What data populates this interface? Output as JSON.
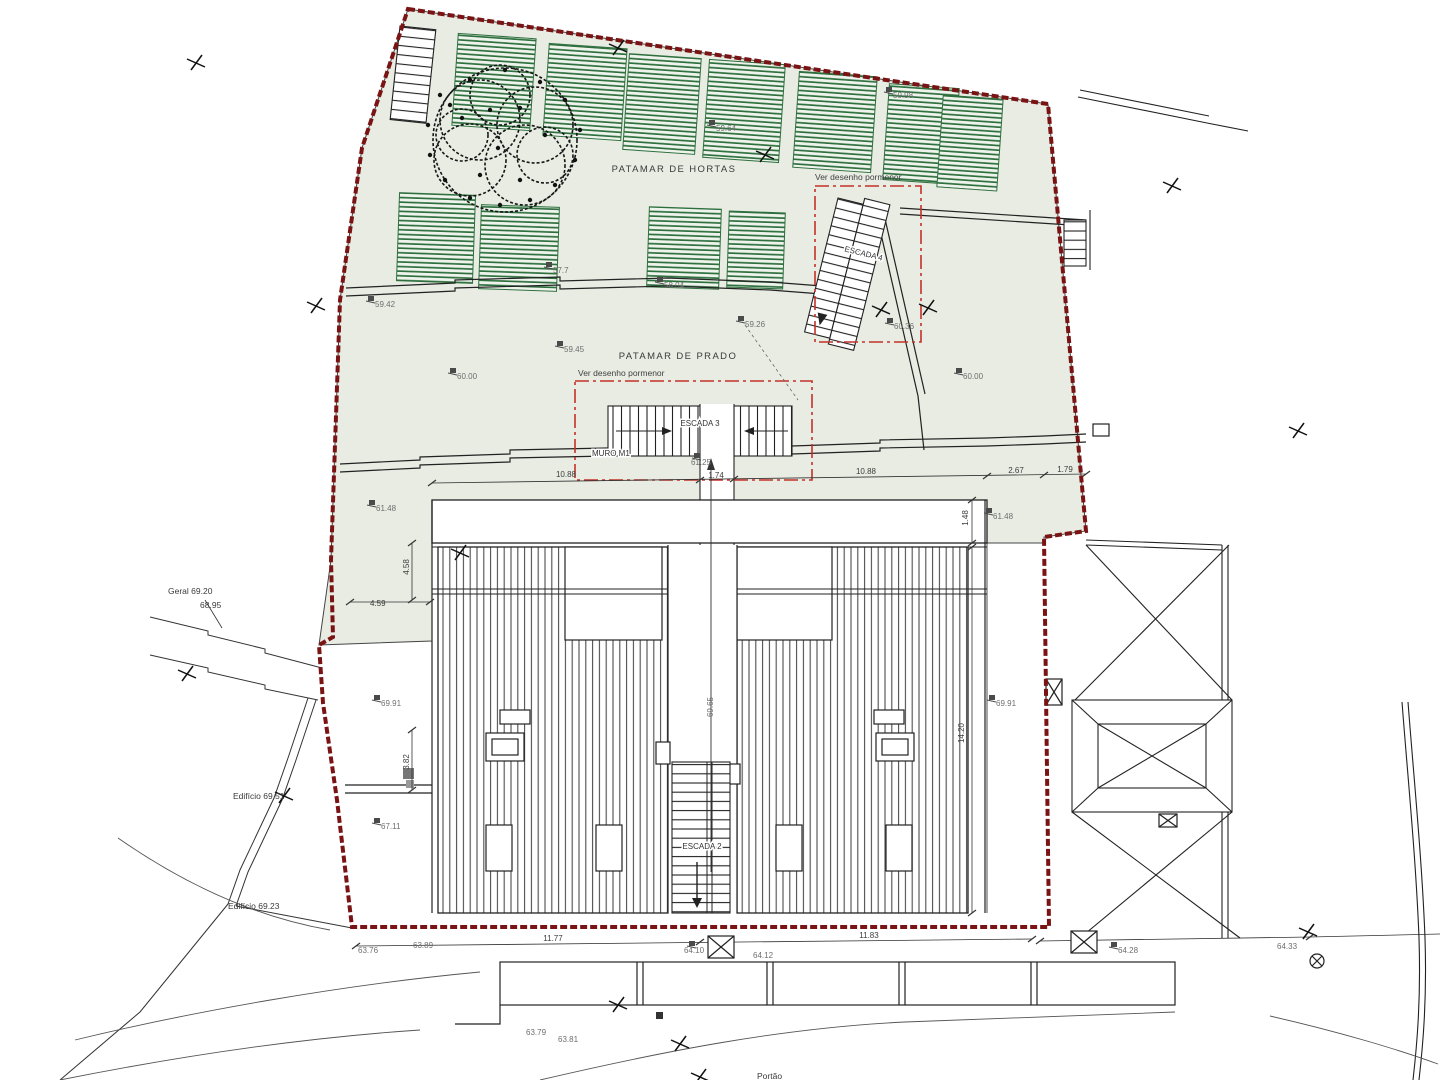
{
  "plan": {
    "areas": {
      "hortas": "PATAMAR DE HORTAS",
      "prado": "PATAMAR DE PRADO"
    },
    "notes": {
      "ver1": "Ver desenho pormenor",
      "ver2": "Ver desenho pormenor"
    },
    "features": {
      "muro": "MURO M1",
      "escada2": "ESCADA 2",
      "escada3": "ESCADA 3",
      "escada4": "ESCADA 4",
      "portao": "Portão"
    },
    "neighbors": {
      "geral": "Geral 69.20",
      "geral_alt": "68.95",
      "edificio_a": "Edifício 69.51",
      "edificio_b": "Edifício 69.23"
    },
    "elevations": [
      "59.98",
      "59.64",
      "57.7",
      "58.04",
      "59.42",
      "59.45",
      "59.26",
      "60.00",
      "60.00",
      "60.36",
      "61.25",
      "61.48",
      "61.48",
      "69.91",
      "69.91",
      "69.65",
      "67.11",
      "63.76",
      "63.89",
      "64.10",
      "64.12",
      "64.28",
      "64.33",
      "63.79",
      "63.81"
    ],
    "dimensions": [
      "10.88",
      "1.74",
      "10.88",
      "2.67",
      "1.79",
      "11.77",
      "11.83",
      "4.58",
      "4.59",
      "1.48",
      "14.20",
      "3.82"
    ],
    "colors": {
      "boundary": "#7a1414",
      "detail_box": "#c23128",
      "terrace_fill": "#e8ece3",
      "garden_hatch": "#2e6f3e",
      "line": "#222222"
    }
  }
}
